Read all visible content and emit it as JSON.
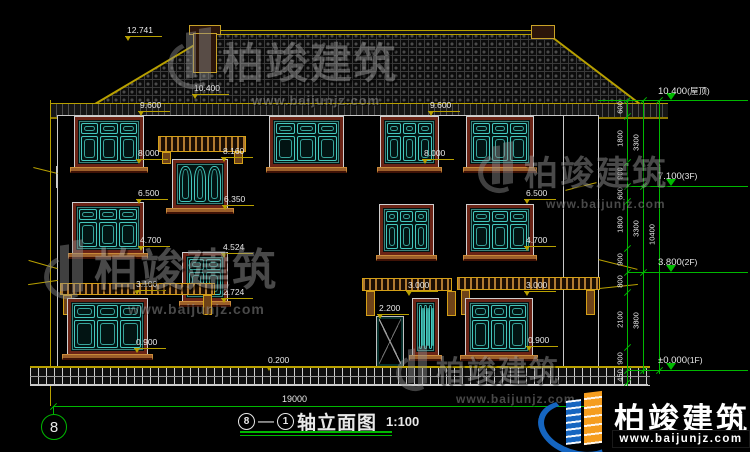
{
  "title": {
    "bubble_left": "8",
    "separator": "—",
    "bubble_right": "1",
    "text": "轴立面图",
    "scale": "1:100"
  },
  "axis_bubble": "8",
  "overall_dim": "19000",
  "facade_dims": [
    "12.741",
    "10.400",
    "9.600",
    "9.600",
    "8.160",
    "8.000",
    "8.000",
    "6.500",
    "6.350",
    "6.500",
    "4.700",
    "4.524",
    "4.700",
    "3.100",
    "3.000",
    "3.000",
    "2.724",
    "2.200",
    "0.900",
    "0.900",
    "0.200"
  ],
  "elevation_flags": [
    {
      "value": "10.400",
      "suffix": "(屋顶)"
    },
    {
      "value": "7.100",
      "suffix": "(3F)"
    },
    {
      "value": "3.800",
      "suffix": "(2F)"
    },
    {
      "value": "±0.000",
      "suffix": "(1F)"
    }
  ],
  "right_chain": {
    "segments": [
      "600",
      "1800",
      "900",
      "600",
      "1800",
      "900",
      "800",
      "2100",
      "900",
      "450"
    ],
    "subtotals": [
      "3300",
      "3300",
      "3800"
    ],
    "total": "10400"
  },
  "watermark": {
    "brand": "柏竣建筑",
    "url": "www.baijunjz.com"
  },
  "colors": {
    "background": "#000000",
    "line_green": "#00b800",
    "line_yellow": "#b8a000",
    "window_teal": "#45c8be",
    "frame_red": "#6b2416",
    "sill_brown": "#9c5f2a",
    "text_white": "#e8e8e8",
    "logo_blue": "#1565c0",
    "logo_orange": "#f59d1e"
  }
}
